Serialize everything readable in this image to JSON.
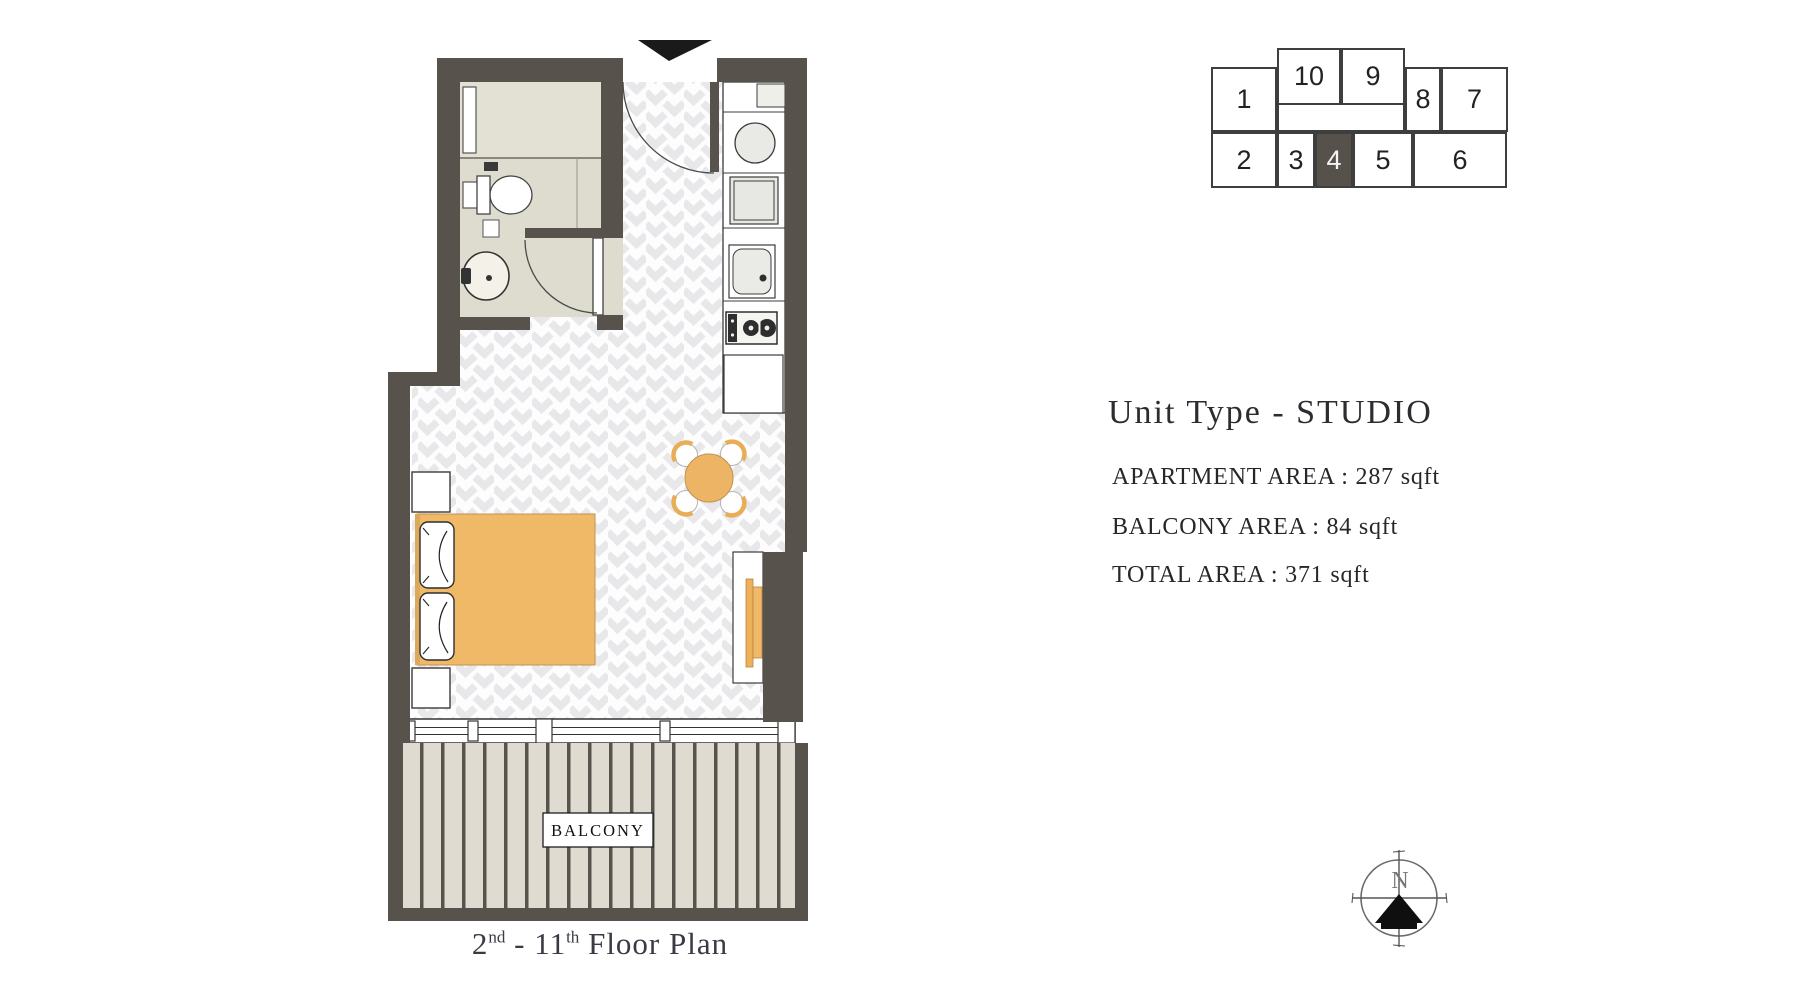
{
  "title_block": {
    "title": "Unit Type - STUDIO",
    "apartment_area": "APARTMENT AREA : 287 sqft",
    "balcony_area": "BALCONY AREA : 84 sqft",
    "total_area": "TOTAL AREA : 371 sqft"
  },
  "caption": {
    "num1": "2",
    "sup1": "nd",
    "mid": " - 11",
    "sup2": "th",
    "rest": " Floor Plan"
  },
  "plan": {
    "balcony_label": "BALCONY",
    "rooms": [
      "bathroom",
      "kitchen",
      "studio room",
      "balcony"
    ],
    "fixtures": [
      "entry-arrow",
      "entry-door",
      "bathroom-door",
      "toilet",
      "wash-basin",
      "vanity",
      "washing-machine",
      "oven",
      "kitchen-sink",
      "gas-hob",
      "kitchen-cabinet",
      "double-bed",
      "pillows",
      "nightstands",
      "dining-table",
      "dining-chairs",
      "tv-unit",
      "sliding-window",
      "balcony-deck"
    ]
  },
  "locator": {
    "highlighted_unit": "4",
    "units": [
      {
        "label": "1"
      },
      {
        "label": "10"
      },
      {
        "label": "9"
      },
      {
        "label": "8"
      },
      {
        "label": "7"
      },
      {
        "label": "2"
      },
      {
        "label": "3"
      },
      {
        "label": "4"
      },
      {
        "label": "5"
      },
      {
        "label": "6"
      }
    ]
  },
  "compass": {
    "north_label": "N"
  },
  "colors": {
    "wall": "#57524c",
    "accent_orange": "#efb968",
    "table_orange": "#edb466",
    "highlight_cell": "#56514a",
    "bathroom_floor": "#dedcce",
    "balcony_plank": "#dfdbd0",
    "chevron": "#e8e8eb"
  }
}
